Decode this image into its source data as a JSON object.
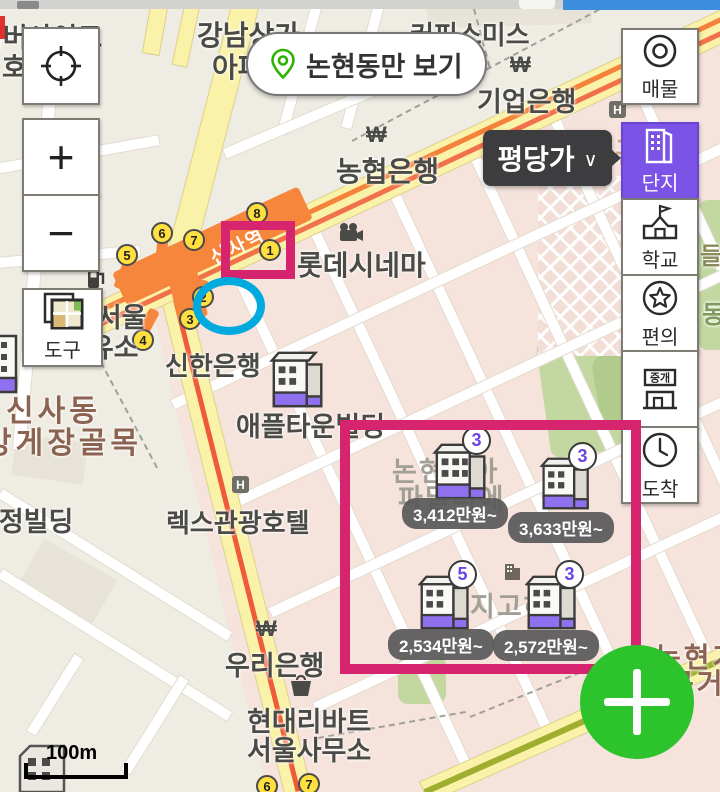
{
  "header": {
    "region_filter": {
      "label": "논현동만 보기",
      "icon": "location-pin-icon"
    },
    "price_mode": {
      "label": "평당가",
      "chevron": "∨"
    }
  },
  "map_controls": {
    "zoom_in": "+",
    "zoom_out": "−",
    "tools_label": "도구"
  },
  "sidebar": {
    "items": [
      {
        "label": "매물",
        "icon": "circle-dot-icon",
        "active": false
      },
      {
        "label": "단지",
        "icon": "building-icon",
        "active": true
      },
      {
        "label": "학교",
        "icon": "school-icon",
        "active": false
      },
      {
        "label": "편의",
        "icon": "star-circle-icon",
        "active": false
      },
      {
        "label": "중개",
        "icon": "shop-icon",
        "active": false
      },
      {
        "label": "도착",
        "icon": "clock-icon",
        "active": false
      }
    ]
  },
  "station": {
    "name": "신사역"
  },
  "exits": [
    "5",
    "6",
    "7",
    "8",
    "1",
    "2",
    "3",
    "4",
    "6",
    "7"
  ],
  "bank_symbol": "₩",
  "hotel_marker": "H",
  "scale_label": "100m",
  "labels": [
    "리버사이드",
    "호텔",
    "강남상가",
    "아파트",
    "커피스미스",
    "기업은행",
    "농협은행",
    "롯데시네마",
    "신한은행",
    "남서울",
    "주유소",
    "애플타운빌딩",
    "신사동",
    "방게장골목",
    "수정빌딩",
    "렉스관광호텔",
    "논현동아",
    "파밀리에",
    "지고하",
    "우리은행",
    "현대리바트",
    "서울사무소",
    "영동관광",
    "들",
    "동",
    "논현가",
    "구거리"
  ],
  "markers": [
    {
      "badge": "3",
      "price": "3,412만원~"
    },
    {
      "badge": "3",
      "price": "3,633만원~"
    },
    {
      "badge": "5",
      "price": "2,534만원~"
    },
    {
      "badge": "3",
      "price": "2,572만원~"
    }
  ],
  "colors": {
    "accent_purple": "#7b53e6",
    "annotation_pink": "#d6246e",
    "annotation_blue": "#00a9de",
    "fab_green": "#2cc32c",
    "subway_orange": "#f5823a",
    "exit_yellow": "#ffe03e"
  }
}
